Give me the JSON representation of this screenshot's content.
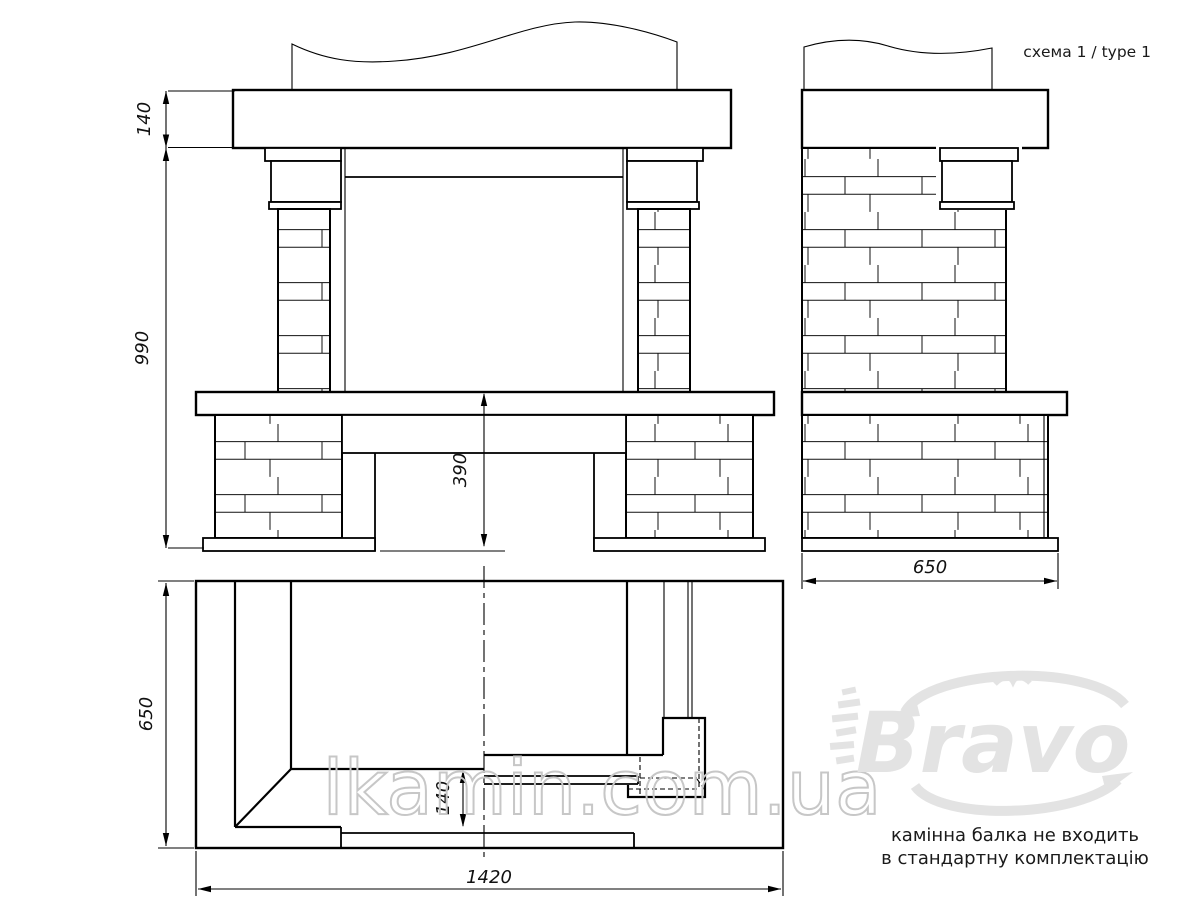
{
  "schema_label": "схема 1 / type 1",
  "note": {
    "line1": "камінна балка не входить",
    "line2": "в стандартну комплектацію"
  },
  "watermarks": {
    "site": "lkamin.com.ua",
    "brand": "Bravo"
  },
  "dimensions": {
    "front": {
      "mantel_thickness": "140",
      "total_height": "990",
      "hearth_height": "390"
    },
    "side": {
      "depth": "650"
    },
    "plan": {
      "depth": "650",
      "width": "1420",
      "hearth_step": "140"
    }
  },
  "colors": {
    "line": "#000000",
    "background": "#ffffff",
    "watermark_fill": "#e3e3e3",
    "watermark_outline": "#c7c7c7"
  }
}
